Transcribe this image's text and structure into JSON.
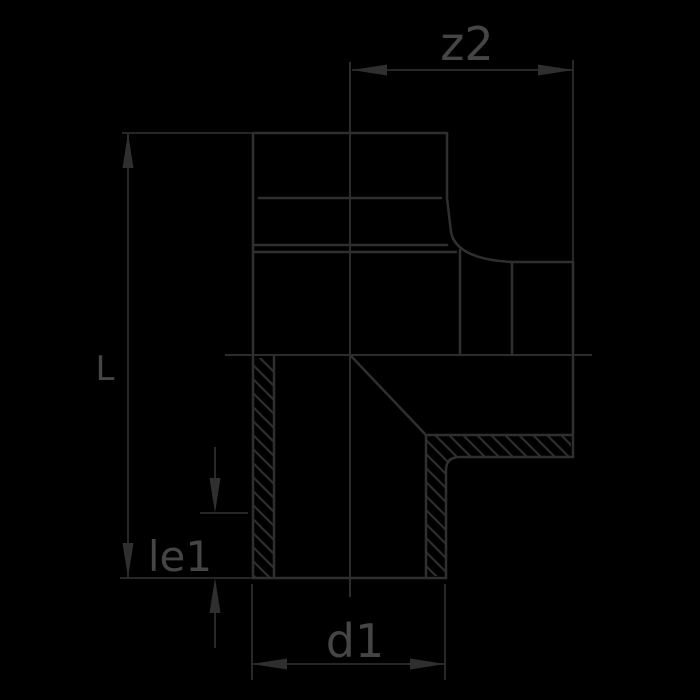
{
  "figure": {
    "type": "pipe-fitting-cross-section-drawing",
    "labels": {
      "z2": "z2",
      "L": "L",
      "le1": "le1",
      "d1": "d1"
    },
    "colors": {
      "background": "#000000",
      "line": "#2f2f2f",
      "thin_line": "#2c2c2c",
      "hatch": "#2d2d2d",
      "text": "#454545"
    }
  }
}
